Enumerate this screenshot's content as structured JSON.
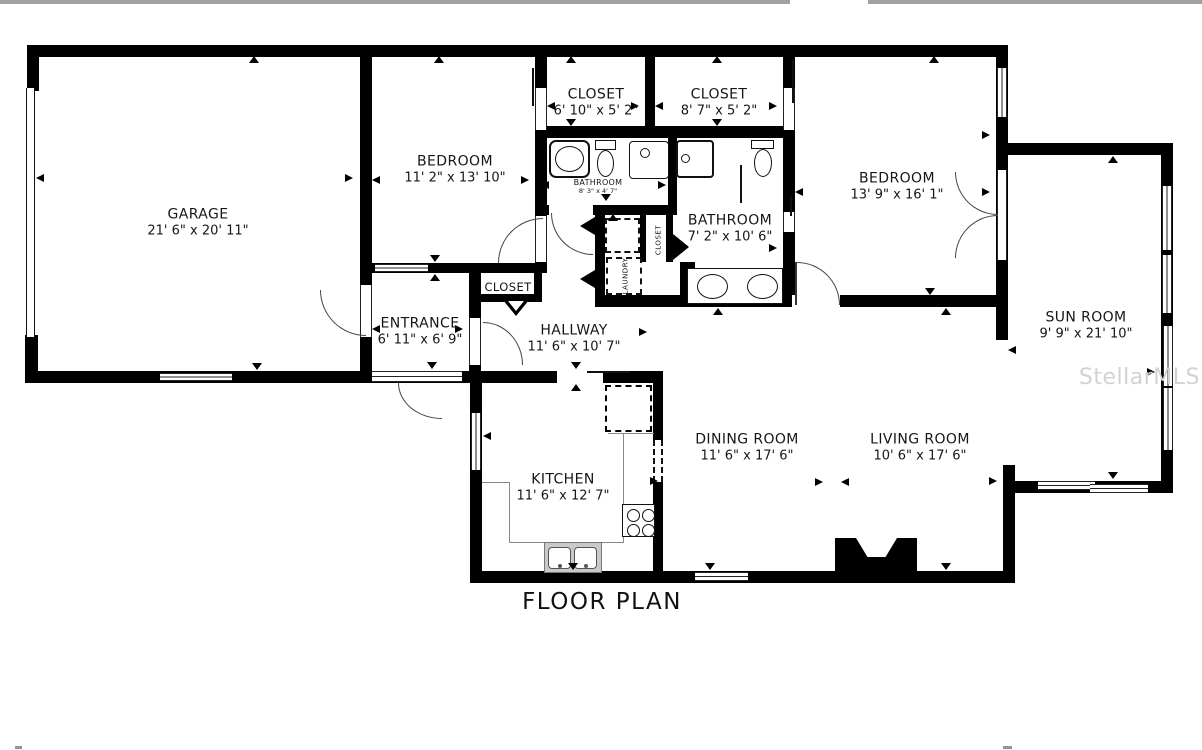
{
  "title": "FLOOR PLAN",
  "watermark": "StellarMLS",
  "rooms": [
    {
      "id": "garage",
      "name": "GARAGE",
      "dims": "21' 6\" x 20' 11\""
    },
    {
      "id": "bedroom1",
      "name": "BEDROOM",
      "dims": "11' 2\" x 13' 10\""
    },
    {
      "id": "closet1",
      "name": "CLOSET",
      "dims": "6' 10\" x 5' 2\""
    },
    {
      "id": "closet2",
      "name": "CLOSET",
      "dims": "8' 7\" x 5' 2\""
    },
    {
      "id": "bedroom2",
      "name": "BEDROOM",
      "dims": "13' 9\" x 16' 1\""
    },
    {
      "id": "bathroom1",
      "name": "BATHROOM",
      "dims": "8' 3\" x 4' 7\""
    },
    {
      "id": "bathroom2",
      "name": "BATHROOM",
      "dims": "7' 2\" x 10' 6\""
    },
    {
      "id": "sunroom",
      "name": "SUN ROOM",
      "dims": "9' 9\" x 21' 10\""
    },
    {
      "id": "entrance",
      "name": "ENTRANCE",
      "dims": "6' 11\" x 6' 9\""
    },
    {
      "id": "hallway",
      "name": "HALLWAY",
      "dims": "11' 6\" x 10' 7\""
    },
    {
      "id": "kitchen",
      "name": "KITCHEN",
      "dims": "11' 6\" x 12' 7\""
    },
    {
      "id": "dining",
      "name": "DINING ROOM",
      "dims": "11' 6\" x 17' 6\""
    },
    {
      "id": "living",
      "name": "LIVING ROOM",
      "dims": "10' 6\" x 17' 6\""
    },
    {
      "id": "closet-hall",
      "name": "CLOSET",
      "dims": ""
    },
    {
      "id": "closet-small",
      "name": "CLOSET",
      "dims": ""
    },
    {
      "id": "laundry",
      "name": "LAUNDRY",
      "dims": ""
    }
  ],
  "colors": {
    "wall": "#000000",
    "text": "#161616",
    "watermark": "#d2d2d2",
    "topbar": "#a1a1a1"
  }
}
